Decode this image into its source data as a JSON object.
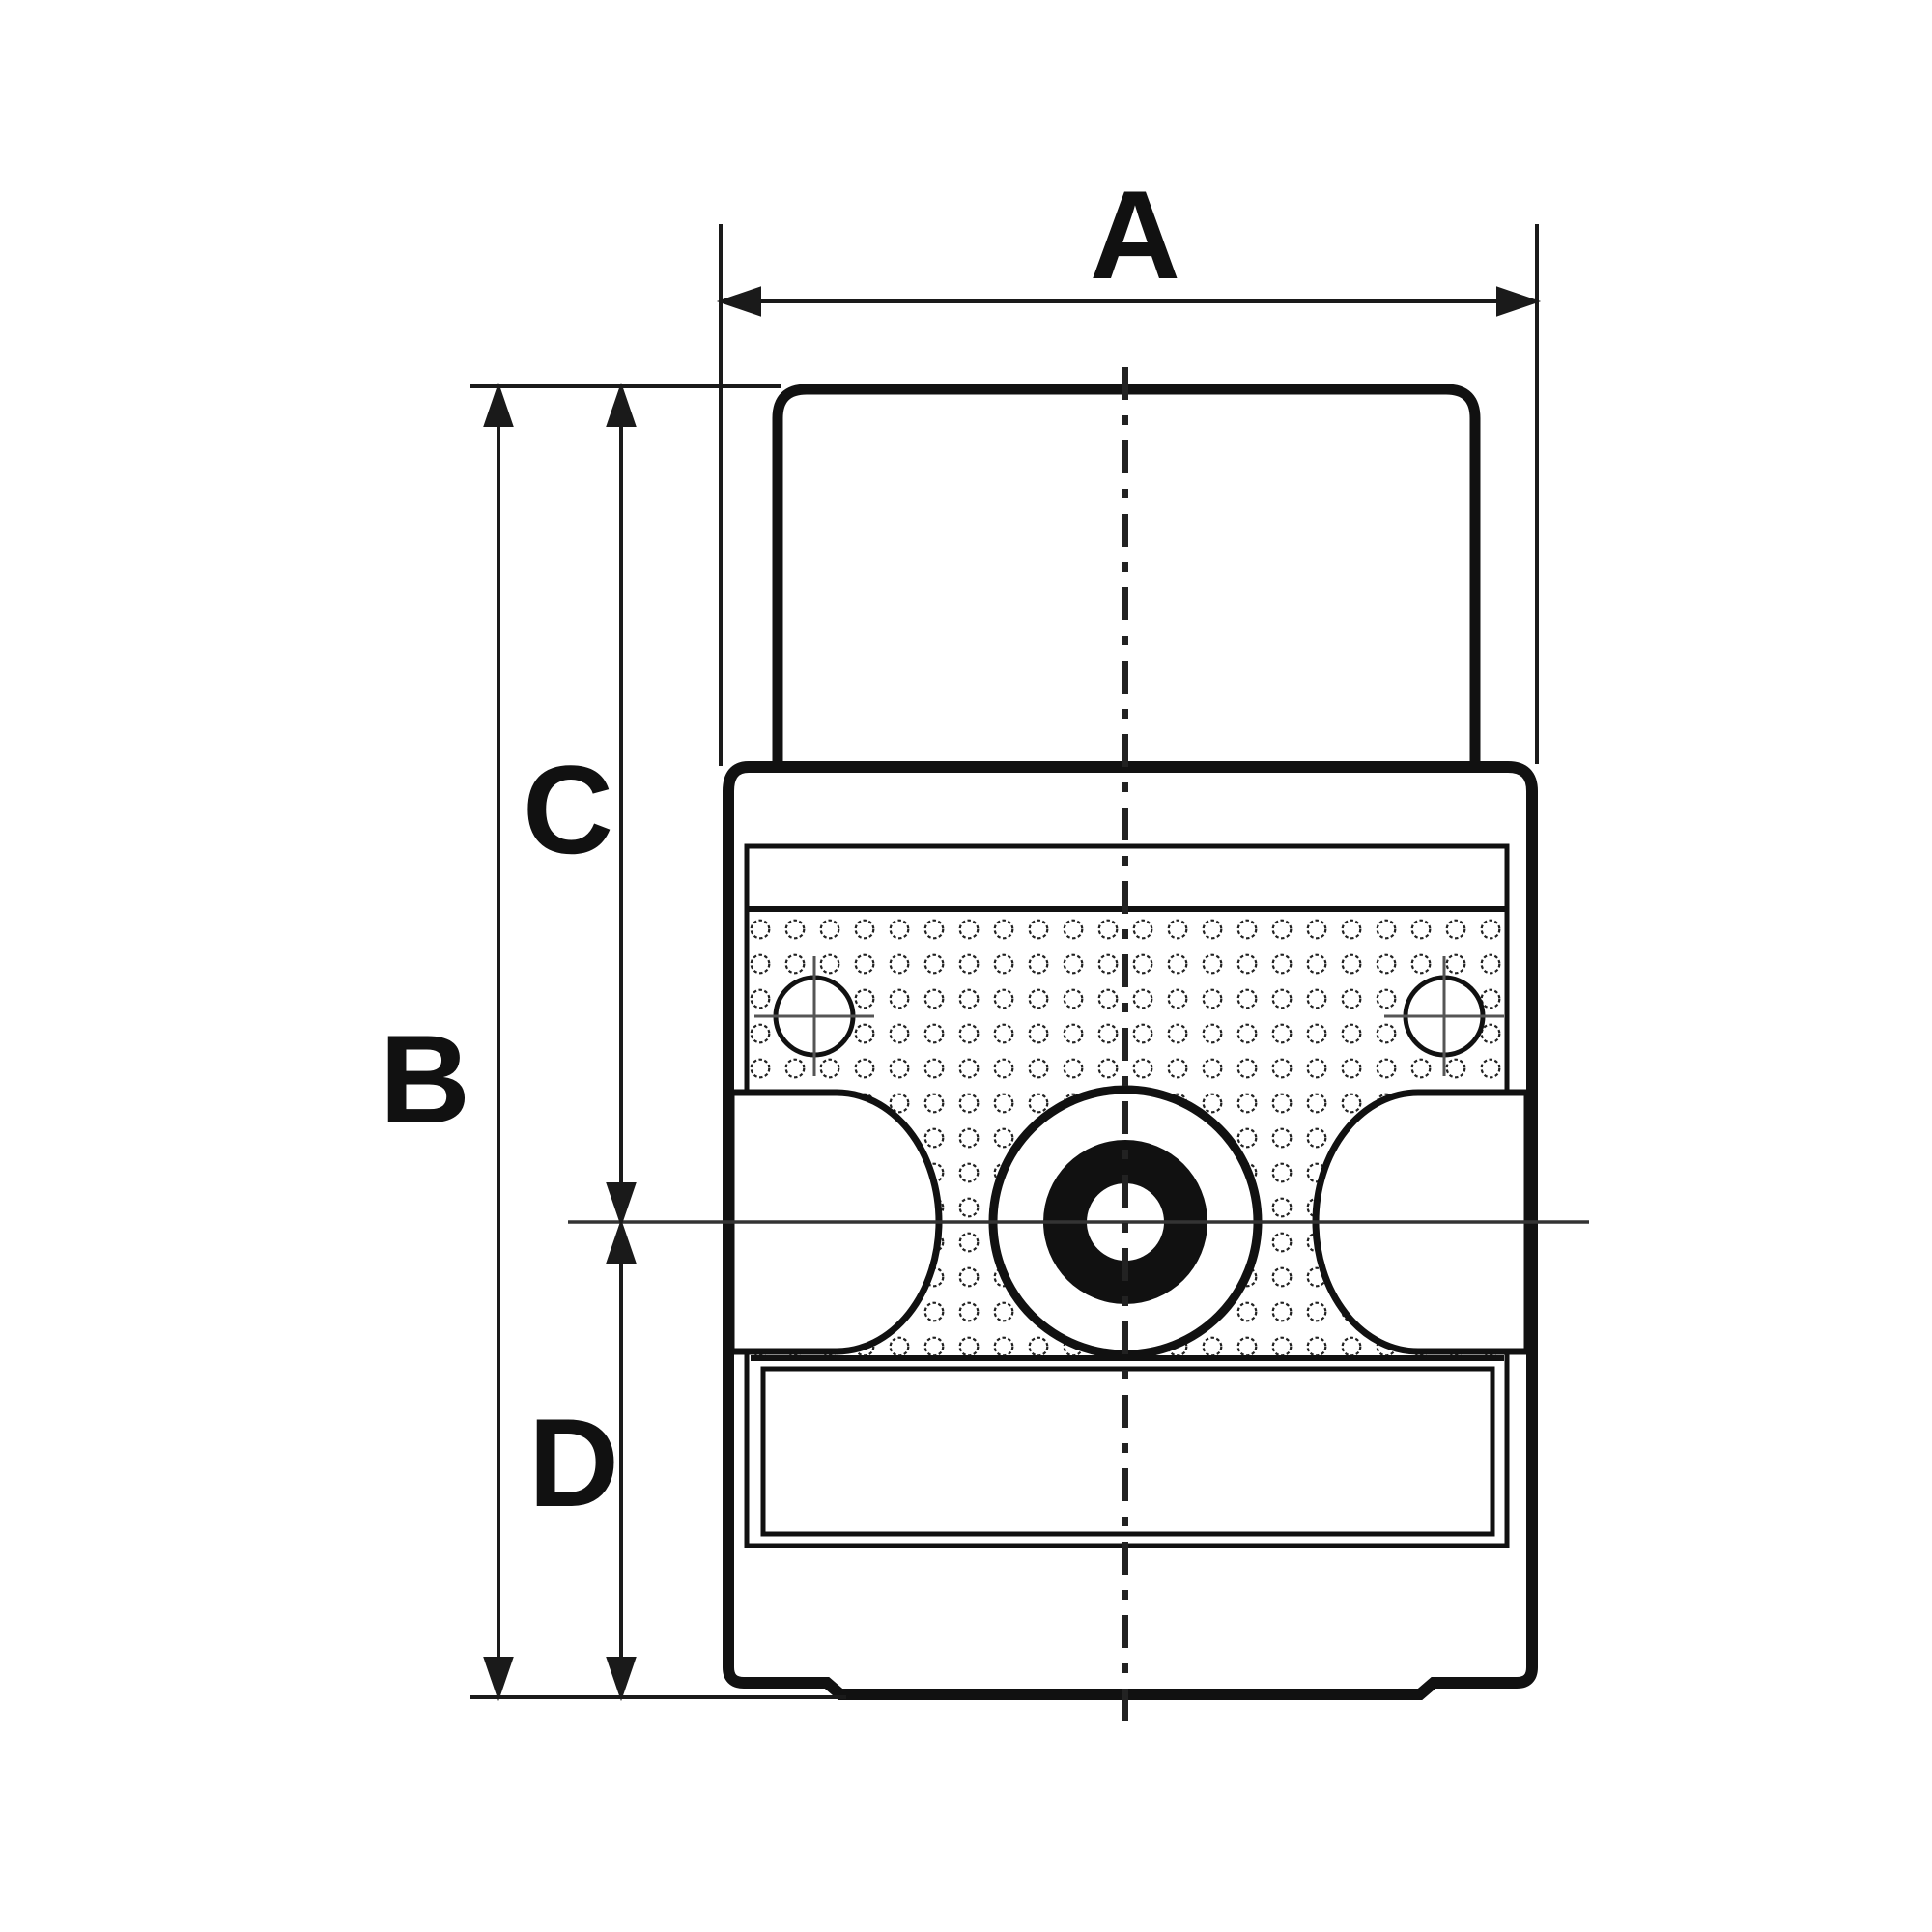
{
  "drawing": {
    "type": "technical-dimension-diagram",
    "subject": "pump front view with dimension callouts",
    "labels": {
      "a": "A",
      "b": "B",
      "c": "C",
      "d": "D"
    },
    "colors": {
      "background": "#ffffff",
      "outline": "#111111",
      "dimension": "#1a1a1a",
      "centerline": "#222222",
      "crosshair": "#555555",
      "perforation": "#222222"
    }
  }
}
